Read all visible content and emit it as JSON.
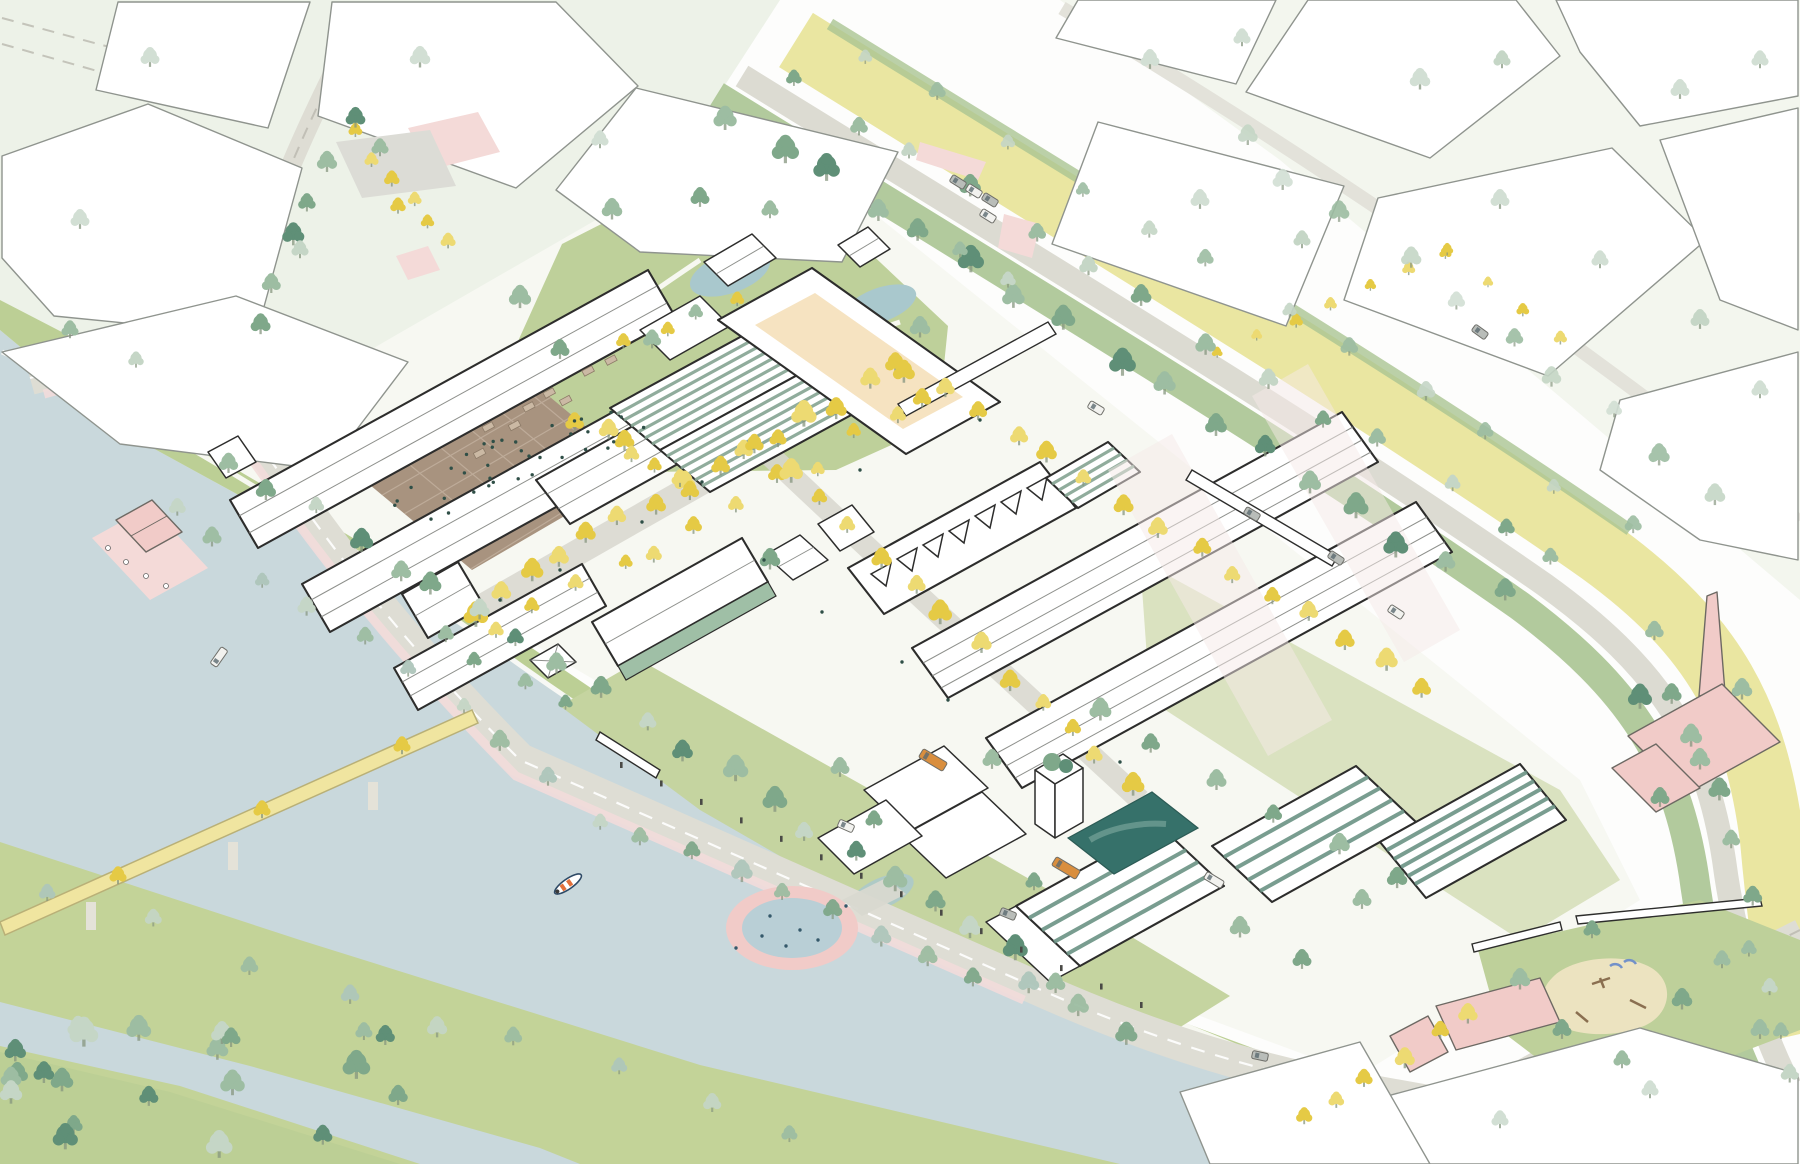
{
  "scene": {
    "type": "axonometric urban masterplan illustration",
    "elements": [
      "existing city blocks drawn as white outlines",
      "redevelopment site with long industrial halls",
      "greenhouse and solar striped roofs",
      "sawtooth-roof hall with skylights",
      "market plaza with crowd and stalls",
      "tree-lined pedestrian spine with yellow trees",
      "main avenue with meadow verge and tree rows",
      "river with floating circular pool",
      "yellow pedestrian bridge on piers",
      "pink boathouse pontoon with terrace tables",
      "pink factory with chimney",
      "playground park with sand pit",
      "courtyard housing with green roofs",
      "tower with roof garden",
      "dark harbour pond",
      "kayak on the river",
      "orange buses and cars on streets"
    ]
  },
  "palette": {
    "paper": "#fdfdfc",
    "contextTint": "#edf2e8",
    "ctxStroke": "#8f948e",
    "siteStroke": "#2d2d2c",
    "innerLine": "#7a7d78",
    "river": "#c9d8dc",
    "pond": "#a9c8cd",
    "poolWater": "#b9cfd6",
    "tealDeep": "#36716a",
    "tealMid": "#6f9d94",
    "bank": "#bccf95",
    "island": "#c3d398",
    "lawn": "#c5d4a0",
    "parkLawn": "#bed09a",
    "road": "#deddd4",
    "roadLight": "#e8e7df",
    "dashGray": "#b9b8ae",
    "aveYellow": "#eae6a1",
    "aveGreen": "#aac492",
    "plazaBrown": "#a8937f",
    "plazaLine": "#c3b2a0",
    "beige": "#f6e3c1",
    "ghBase": "#e0e9df",
    "ghStripe": "#84a492",
    "stepBase": "#cfe0cf",
    "stepStripe": "#6b9384",
    "pinkBldg": "#f1cbc8",
    "pinkSoft": "#f4dad8",
    "pinkPath": "#f2dbda",
    "pinkWash": "#f6e9e8",
    "bridge": "#f0e5a0",
    "bridgeStroke": "#b9b077",
    "busOrange": "#d98e3e",
    "boatNavy": "#2e4a66",
    "boatOrange": "#e2703a",
    "people": "#2f4f47",
    "treeYellow": "#e5ca45",
    "treeYellowLt": "#edda72",
    "treeSage": "#9dbda2",
    "treeMid": "#7fa88a",
    "treeDark": "#5f8f77",
    "treePale": "#c5d6c6",
    "treeGhost": "#d2dfd4",
    "treeBlue": "#aec6bb",
    "trunk": "#85967f",
    "postDark": "#4a4a46",
    "sand": "#ece3c0",
    "carGray": "#b9bdb9",
    "carWhite": "#f2f2ef",
    "grayCourt": "#dcdcd6"
  }
}
